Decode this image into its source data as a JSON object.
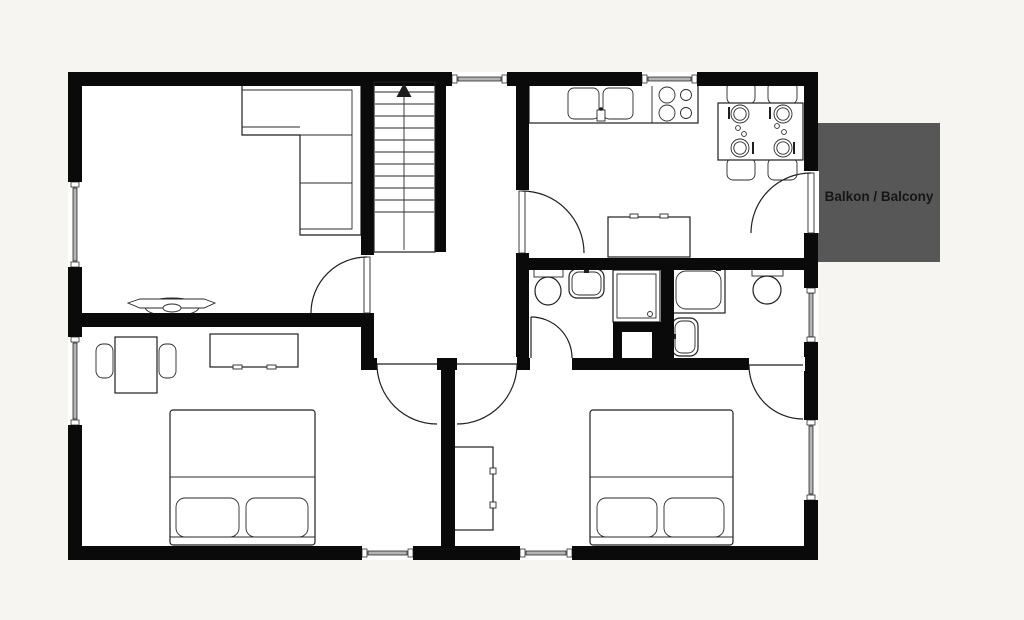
{
  "balcony": {
    "label": "Balkon / Balcony",
    "fill": "#575757",
    "text_color": "#161616"
  },
  "canvas": {
    "background": "#f6f5f1",
    "floor": "#ffffff",
    "wall": "#0a0a0a",
    "outline": "#1f1f1f",
    "window_band": "#b4b4b4"
  },
  "plan": {
    "type": "apartment-floor-plan",
    "furniture_icons": [
      "corner-sofa-icon",
      "curved-console-icon",
      "staircase-up-arrow-icon",
      "kitchen-counter-icon",
      "double-sink-icon",
      "cooktop-4-burner-icon",
      "dining-table-icon",
      "dining-chair-icon",
      "plate-icon",
      "kitchen-island-icon",
      "toilet-icon",
      "washbasin-icon",
      "shower-tray-icon",
      "bathtub-icon",
      "duct-shaft-icon",
      "double-bed-icon",
      "pillow-icon",
      "sideboard-icon",
      "wardrobe-icon",
      "desk-icon",
      "desk-chair-icon",
      "door-swing-icon",
      "window-icon"
    ]
  }
}
